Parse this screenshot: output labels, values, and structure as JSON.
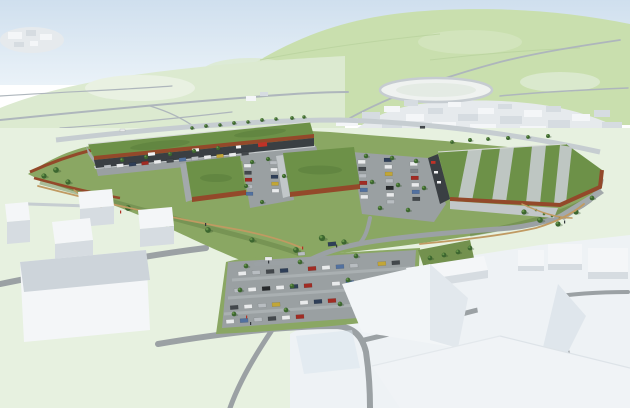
{
  "colors": {
    "sky_top": "#cfdfee",
    "sky_bottom": "#eaf2f8",
    "hill_green": "#c9dfae",
    "hill_light": "#dcead0",
    "field_pale": "#e9f1e2",
    "bg_road": "#aeb6bc",
    "bg_road_light": "#c6cdd1",
    "massing_top": "#f4f6f8",
    "massing_side": "#d6dce1",
    "massing_roof": "#cdd4da",
    "town_base": "#e6eaed",
    "fg_field": "#e7f1e0",
    "fg_white": "#eef2f5",
    "site_grass": "#8aa763",
    "slope_grass": "#73914e",
    "grass_dark": "#5f7f42",
    "green_roof": "#6d9148",
    "green_roof_dark": "#55793a",
    "roof_stripe": "#c6cbcd",
    "corten": "#93492a",
    "facade_dark": "#3a3f43",
    "wall_concrete": "#c2c7c9",
    "wall_grey": "#a3a9ab",
    "gabion": "#787c7b",
    "asphalt": "#9aa0a2",
    "asphalt_light": "#aab0b2",
    "road_grey": "#9ba1a4",
    "sidewalk": "#c9cecf",
    "path_tan": "#c09a62",
    "tree_dark": "#3c662f",
    "tree_light": "#6f9c4f",
    "tree_shadow": "#2c4a26",
    "shrub": "#4f7a39",
    "parapet_light": "#d8dcd8",
    "car_white": "#e9ebec",
    "car_silver": "#b8bdc1",
    "car_grey": "#7e8488",
    "car_dark": "#43484c",
    "car_navy": "#2f3f58",
    "car_blue": "#52719f",
    "car_red": "#a12c24",
    "car_yellow": "#c2a637",
    "car_black": "#26292b",
    "sign_red": "#c03227",
    "sign_white": "#f2f3f4",
    "person_dark": "#33383c",
    "person_red": "#b03327"
  }
}
